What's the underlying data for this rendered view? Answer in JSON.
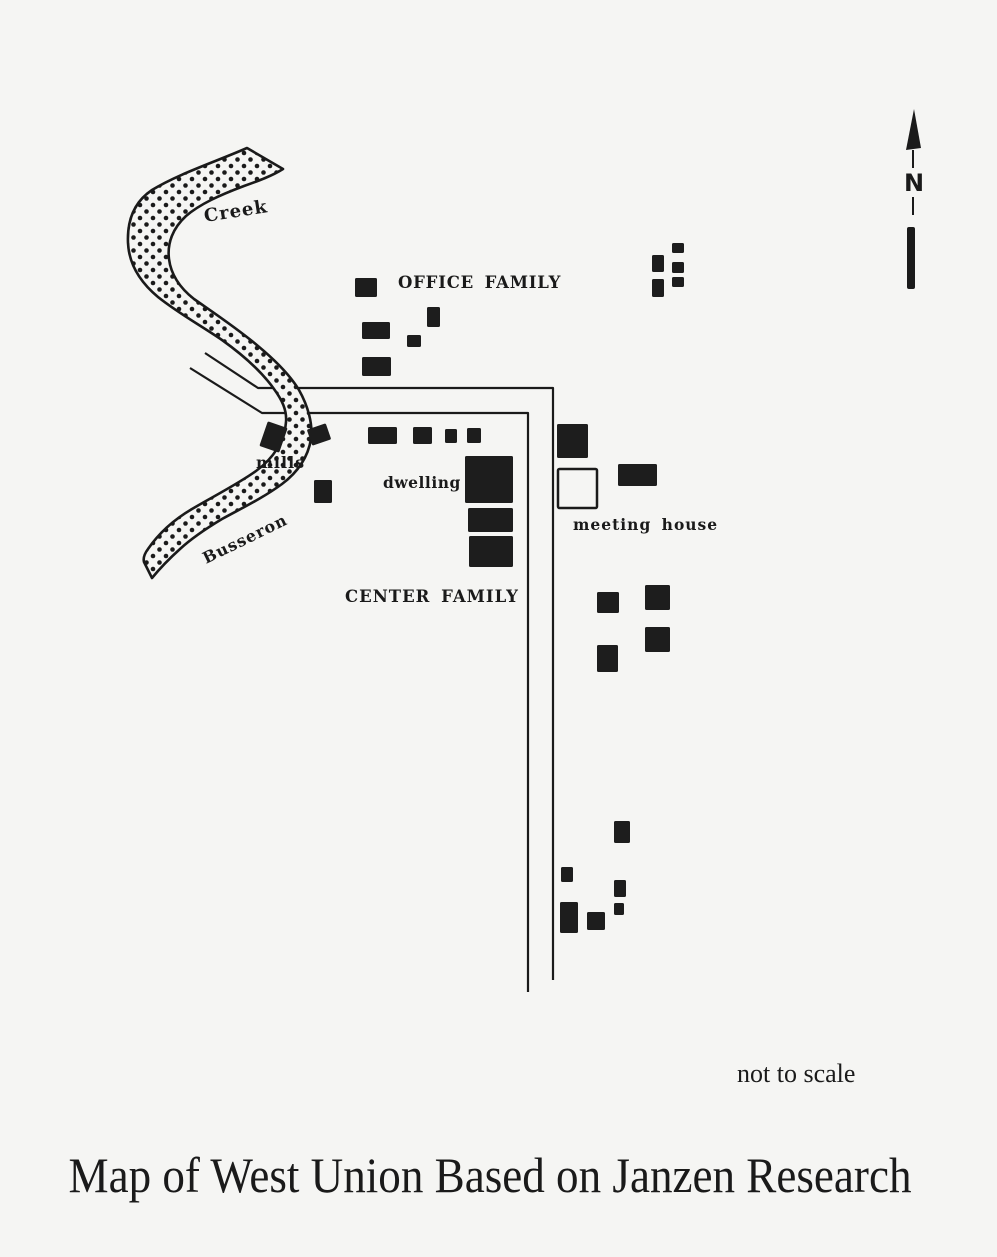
{
  "colors": {
    "paper": "#f5f5f3",
    "ink": "#1a1a1a",
    "building": "#1d1d1d"
  },
  "map": {
    "title": "Map of West Union Based on Janzen Research",
    "labels": {
      "creek": "Creek",
      "busseron": "Busseron",
      "office_family": "OFFICE FAMILY",
      "center_family": "CENTER FAMILY",
      "mills": "mills",
      "dwelling": "dwelling",
      "meeting_house": "meeting house",
      "north": "N",
      "not_to_scale": "not to scale"
    },
    "buildings": [
      {
        "name": "office-family-building",
        "x": 355,
        "y": 278,
        "w": 22,
        "h": 19
      },
      {
        "name": "office-family-building",
        "x": 427,
        "y": 307,
        "w": 13,
        "h": 20
      },
      {
        "name": "office-family-building",
        "x": 362,
        "y": 322,
        "w": 28,
        "h": 17
      },
      {
        "name": "office-family-building",
        "x": 407,
        "y": 335,
        "w": 14,
        "h": 12
      },
      {
        "name": "office-family-building",
        "x": 362,
        "y": 357,
        "w": 29,
        "h": 19
      },
      {
        "name": "northeast-building",
        "x": 672,
        "y": 243,
        "w": 12,
        "h": 10
      },
      {
        "name": "northeast-building",
        "x": 652,
        "y": 255,
        "w": 12,
        "h": 17
      },
      {
        "name": "northeast-building",
        "x": 672,
        "y": 262,
        "w": 12,
        "h": 11
      },
      {
        "name": "northeast-building",
        "x": 672,
        "y": 277,
        "w": 12,
        "h": 10
      },
      {
        "name": "northeast-building",
        "x": 652,
        "y": 279,
        "w": 12,
        "h": 18
      },
      {
        "name": "center-family-building",
        "x": 368,
        "y": 427,
        "w": 29,
        "h": 17
      },
      {
        "name": "center-family-building",
        "x": 413,
        "y": 427,
        "w": 19,
        "h": 17
      },
      {
        "name": "center-family-building",
        "x": 445,
        "y": 429,
        "w": 12,
        "h": 14
      },
      {
        "name": "center-family-building",
        "x": 467,
        "y": 428,
        "w": 14,
        "h": 15
      },
      {
        "name": "dwelling-building",
        "x": 465,
        "y": 456,
        "w": 48,
        "h": 47
      },
      {
        "name": "dwelling-building",
        "x": 468,
        "y": 508,
        "w": 45,
        "h": 24
      },
      {
        "name": "dwelling-building",
        "x": 469,
        "y": 536,
        "w": 44,
        "h": 31
      },
      {
        "name": "mill-building",
        "x": 263,
        "y": 424,
        "w": 21,
        "h": 26,
        "rot": 19
      },
      {
        "name": "mill-building",
        "x": 309,
        "y": 426,
        "w": 20,
        "h": 17,
        "rot": -19
      },
      {
        "name": "mill-area-building",
        "x": 314,
        "y": 480,
        "w": 18,
        "h": 23
      },
      {
        "name": "east-building",
        "x": 557,
        "y": 424,
        "w": 31,
        "h": 34
      },
      {
        "name": "meeting-house",
        "x": 558,
        "y": 469,
        "w": 39,
        "h": 39,
        "style": "outline"
      },
      {
        "name": "east-building",
        "x": 618,
        "y": 464,
        "w": 39,
        "h": 22
      },
      {
        "name": "east-building",
        "x": 597,
        "y": 592,
        "w": 22,
        "h": 21
      },
      {
        "name": "east-building",
        "x": 645,
        "y": 585,
        "w": 25,
        "h": 25
      },
      {
        "name": "east-building",
        "x": 645,
        "y": 627,
        "w": 25,
        "h": 25
      },
      {
        "name": "east-building",
        "x": 597,
        "y": 645,
        "w": 21,
        "h": 27
      },
      {
        "name": "south-building",
        "x": 614,
        "y": 821,
        "w": 16,
        "h": 22
      },
      {
        "name": "south-building",
        "x": 561,
        "y": 867,
        "w": 12,
        "h": 15
      },
      {
        "name": "south-building",
        "x": 614,
        "y": 880,
        "w": 12,
        "h": 17
      },
      {
        "name": "south-building",
        "x": 614,
        "y": 903,
        "w": 10,
        "h": 12
      },
      {
        "name": "south-building",
        "x": 560,
        "y": 902,
        "w": 18,
        "h": 31
      },
      {
        "name": "south-building",
        "x": 587,
        "y": 912,
        "w": 18,
        "h": 18
      }
    ]
  }
}
